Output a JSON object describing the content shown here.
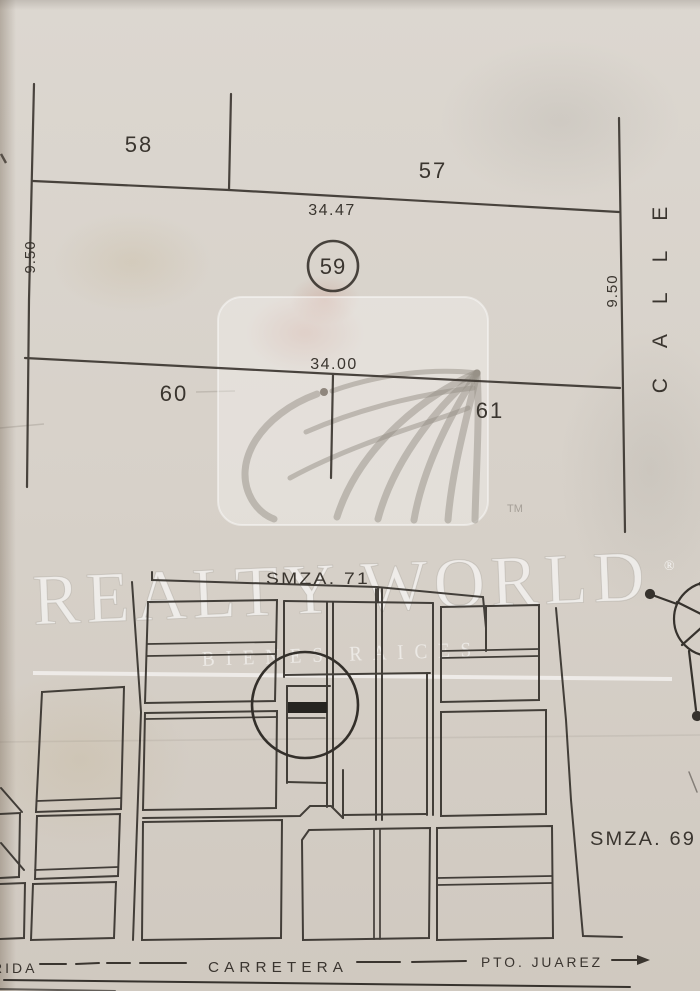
{
  "watermark": {
    "brand": "REALTY WORLD",
    "registered_mark": "®",
    "trademark_mark": "TM",
    "tagline": "BIENES RAICES"
  },
  "upper_plat": {
    "lot58": "58",
    "lot57": "57",
    "lot59": "59",
    "lot60": "60",
    "lot61": "61",
    "dim_top": "34.47",
    "dim_bottom": "34.00",
    "dim_left": "9.50",
    "dim_right": "9.50",
    "street_name": "CALLE"
  },
  "lower_map": {
    "smza71": "SMZA. 71",
    "smza69": "SMZA. 69",
    "road_left_label": "RIDA",
    "road_center_label": "CARRETERA",
    "road_right_label": "PTO. JUAREZ"
  },
  "colors": {
    "paper": "#d7d1c9",
    "ink": "#38332d",
    "watermark": "#ffffff",
    "highlight_fill": "#262420"
  }
}
